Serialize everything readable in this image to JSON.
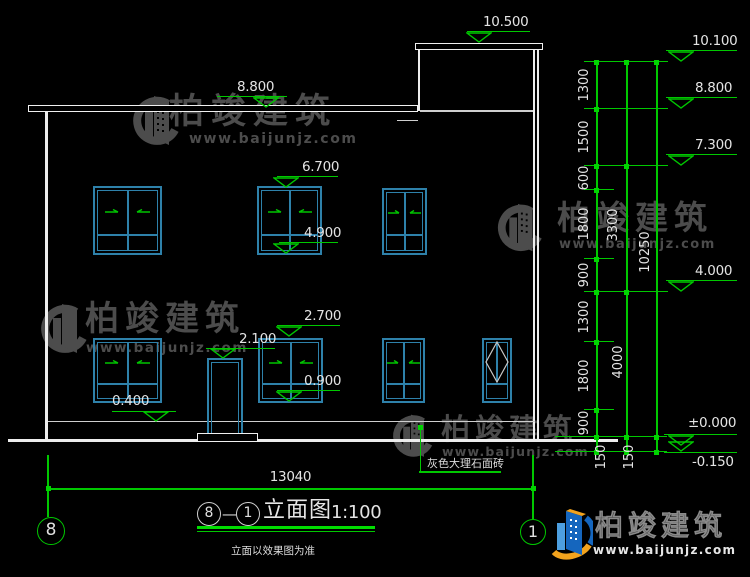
{
  "watermark": {
    "name": "柏竣建筑",
    "url": "www.baijunjz.com"
  },
  "brand": {
    "name": "柏竣建筑",
    "url": "www.baijunjz.com"
  },
  "levels_left": {
    "l10500": "10.500",
    "l8800": "8.800",
    "l6700": "6.700",
    "l4900": "4.900",
    "l2700": "2.700",
    "l2100": "2.100",
    "l0900": "0.900",
    "l0400": "0.400"
  },
  "levels_right": {
    "l10100": "10.100",
    "l8800": "8.800",
    "l7300": "7.300",
    "l4000": "4.000",
    "l0000": "±0.000",
    "ln150": "-0.150"
  },
  "dims": {
    "bottom_total": "13040",
    "col_segments": [
      "1300",
      "1500",
      "600",
      "1800",
      "900",
      "1300",
      "1800",
      "900"
    ],
    "bottom_segments": [
      "150",
      "150"
    ],
    "col_groups": [
      "3300",
      "4000"
    ],
    "col_total": "10250"
  },
  "notes": {
    "material": "灰色大理石面砖",
    "basis": "立面以效果图为准"
  },
  "title_block": {
    "bubble_left": "8",
    "dash": "—",
    "bubble_right": "1",
    "name": "立面图",
    "scale": "1:100"
  },
  "axis_bubbles": {
    "left": "8",
    "right": "1"
  }
}
